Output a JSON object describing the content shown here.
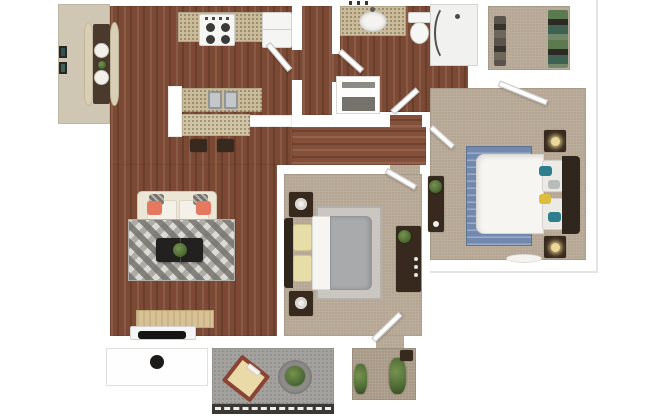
{
  "meta": {
    "description": "3D top-down rendered floor plan of a two-bedroom, one-bath apartment with living room, kitchen with breakfast bar, dining nook, hallway closets, walk-in closet and patio",
    "view": "top-down-3d",
    "text_content": "none — image contains no rendered text"
  },
  "colors": {
    "background": "#ffffff",
    "wall": "#ffffff",
    "wall_edge": "#d6d3cf",
    "wood": "#7c4a34",
    "wood_hall": "#84503a",
    "floor_dining": "#cfc6b4",
    "carpet": "#b5a694",
    "carpet_closet": "#a89a87",
    "concrete": "#a3a29e",
    "granite": "#cabb9b",
    "bar_granite": "#d2c5a6",
    "steel": "#c3c7c9",
    "sofa": "#ece6d6",
    "sofa_seat": "#f4f1e8",
    "pillow_coral": "#e5795f",
    "pillow_stripe": "#75716a",
    "rug_light": "#dcdad5",
    "rug_dark": "#94918c",
    "rug_blue": "#7289ad",
    "rug_gray": "#cac7c2",
    "table_black": "#23211f",
    "plant": "#527037",
    "plant_dark": "#3c5428",
    "duvet_white": "#f6f5f2",
    "duvet_gray": "#a8aaac",
    "headboard": "#2f261e",
    "furniture_dark": "#37291d",
    "pillow_cream": "#e7dda9",
    "lamp": "#ecd79a",
    "teal": "#2e7e8d",
    "yellow": "#dcbd3c",
    "bench": "#d8cfb6",
    "dining_table": "#4a3a2e",
    "plate": "#f2f0ea",
    "tv": "#161515",
    "sideboard": "#d8c295",
    "patio_table": "#8a4434",
    "patio_table_top": "#e9daa8",
    "railing": "#3a3734",
    "clothes_teal": "#3f6152",
    "clothes_dark": "#2d2a26",
    "clothes_green": "#5c7a50",
    "door_edge": "#c7c4c0",
    "entry_dot": "#1c1b1a",
    "shower_glass": "#4f4f4f",
    "shelf_slot": "#8e8a84"
  },
  "rooms": [
    {
      "name": "dining-nook",
      "furniture": [
        "banquette-bench-left",
        "banquette-bench-right",
        "dining-table",
        "place-settings",
        "wall-art"
      ]
    },
    {
      "name": "kitchen",
      "furniture": [
        "range-stove",
        "refrigerator",
        "granite-counter",
        "double-sink",
        "breakfast-bar",
        "bar-stools"
      ]
    },
    {
      "name": "bathroom",
      "furniture": [
        "granite-vanity",
        "oval-sink",
        "toilet",
        "curved-glass-shower"
      ]
    },
    {
      "name": "linen-closet",
      "furniture": [
        "shelves"
      ]
    },
    {
      "name": "walk-in-closet",
      "furniture": [
        "hanging-clothes-left",
        "hanging-clothes-right"
      ]
    },
    {
      "name": "master-bedroom",
      "furniture": [
        "white-bed",
        "headboard",
        "nightstand-north",
        "nightstand-south",
        "lamps",
        "dresser",
        "blue-striped-rug",
        "floor-mat",
        "accent-pillows-teal-yellow"
      ]
    },
    {
      "name": "bedroom-2",
      "furniture": [
        "gray-bed",
        "headboard",
        "nightstand-north",
        "nightstand-south",
        "decor-bowls",
        "dresser-with-plant",
        "gray-rug"
      ]
    },
    {
      "name": "bedroom-2-closet",
      "furniture": [
        "plants",
        "storage-box"
      ]
    },
    {
      "name": "living-room",
      "furniture": [
        "cream-sofa",
        "coral-pillows",
        "chevron-rug",
        "black-coffee-table",
        "potted-plant",
        "media-console",
        "flat-tv",
        "sideboard"
      ]
    },
    {
      "name": "hallway",
      "furniture": []
    },
    {
      "name": "patio",
      "furniture": [
        "bistro-table",
        "round-planter",
        "railing"
      ]
    },
    {
      "name": "entry",
      "furniture": [
        "door-knob-marker"
      ]
    }
  ],
  "doors": [
    "kitchen-door",
    "bathroom-west-door",
    "bathroom-hall-door",
    "master-entry-door",
    "master-closet-door",
    "bedroom2-entry-door",
    "bedroom2-closet-door"
  ]
}
